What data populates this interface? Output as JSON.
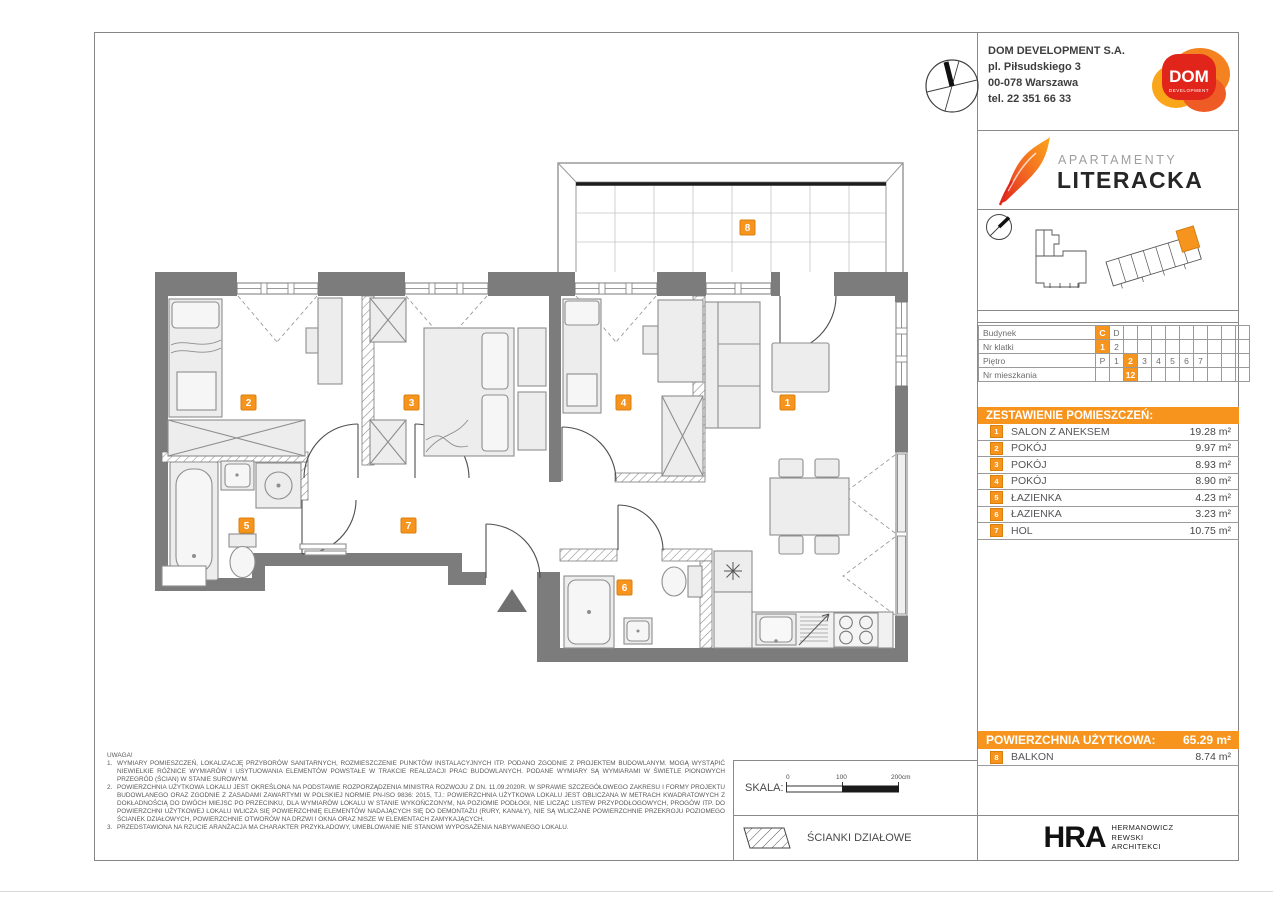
{
  "header": {
    "company_name": "DOM DEVELOPMENT S.A.",
    "address_line1": "pl. Piłsudskiego 3",
    "address_line2": "00-078 Warszawa",
    "phone": "tel. 22 351 66 33",
    "logo_text": "DOM",
    "logo_subtext": "DEVELOPMENT"
  },
  "brand": {
    "line1": "APARTAMENTY",
    "line2": "LITERACKA"
  },
  "unit_table": {
    "rows": [
      {
        "label": "Budynek",
        "cells": [
          "C",
          "D",
          "",
          "",
          "",
          "",
          "",
          "",
          "",
          "",
          ""
        ]
      },
      {
        "label": "Nr klatki",
        "cells": [
          "1",
          "2",
          "",
          "",
          "",
          "",
          "",
          "",
          "",
          "",
          ""
        ]
      },
      {
        "label": "Piętro",
        "cells": [
          "P",
          "1",
          "2",
          "3",
          "4",
          "5",
          "6",
          "7",
          "",
          "",
          ""
        ]
      },
      {
        "label": "Nr mieszkania",
        "cells": [
          "",
          "",
          "12",
          "",
          "",
          "",
          "",
          "",
          "",
          "",
          ""
        ]
      }
    ]
  },
  "rooms": {
    "header": "ZESTAWIENIE POMIESZCZEŃ:",
    "items": [
      {
        "no": "1",
        "name": "SALON Z ANEKSEM",
        "area": "19.28 m²"
      },
      {
        "no": "2",
        "name": "POKÓJ",
        "area": "9.97 m²"
      },
      {
        "no": "3",
        "name": "POKÓJ",
        "area": "8.93 m²"
      },
      {
        "no": "4",
        "name": "POKÓJ",
        "area": "8.90 m²"
      },
      {
        "no": "5",
        "name": "ŁAZIENKA",
        "area": "4.23 m²"
      },
      {
        "no": "6",
        "name": "ŁAZIENKA",
        "area": "3.23 m²"
      },
      {
        "no": "7",
        "name": "HOL",
        "area": "10.75 m²"
      }
    ]
  },
  "summary": {
    "label": "POWIERZCHNIA UŻYTKOWA:",
    "value": "65.29 m²",
    "balcony_no": "8",
    "balcony_name": "BALKON",
    "balcony_area": "8.74 m²"
  },
  "notes": {
    "title": "UWAGA!",
    "items": [
      "WYMIARY POMIESZCZEŃ, LOKALIZACJĘ PRZYBORÓW SANITARNYCH, ROZMIESZCZENIE PUNKTÓW INSTALACYJNYCH ITP. PODANO ZGODNIE Z PROJEKTEM BUDOWLANYM. MOGĄ WYSTĄPIĆ NIEWIELKIE RÓŻNICE WYMIARÓW I USYTUOWANIA ELEMENTÓW POWSTAŁE W TRAKCIE REALIZACJI PRAC BUDOWLANYCH. PODANE WYMIARY SĄ WYMIARAMI W ŚWIETLE PIONOWYCH PRZEGRÓD (ŚCIAN) W STANIE SUROWYM.",
      "POWIERZCHNIA UŻYTKOWA LOKALU JEST OKREŚLONA NA PODSTAWIE ROZPORZĄDZENIA MINISTRA ROZWOJU Z DN. 11.09.2020R. W SPRAWIE SZCZEGÓŁOWEGO ZAKRESU I FORMY PROJEKTU BUDOWLANEGO ORAZ ZGODNIE Z ZASADAMI ZAWARTYMI W POLSKIEJ NORMIE PN-ISO 9836: 2015, TJ.: POWIERZCHNIA UŻYTKOWA LOKALU JEST OBLICZANA W METRACH KWADRATOWYCH Z DOKŁADNOŚCIĄ DO DWÓCH MIEJSC PO PRZECINKU, DLA WYMIARÓW LOKALU W STANIE WYKOŃCZONYM, NA POZIOMIE PODŁOGI, NIE LICZĄC LISTEW PRZYPODŁOGOWYCH, PROGÓW ITP. DO POWIERZCHNI UŻYTKOWEJ LOKALU WLICZA SIĘ POWIERZCHNIĘ ELEMENTÓW NADAJĄCYCH SIĘ DO DEMONTAŻU (RURY, KANAŁY), NIE SĄ WLICZANE POWIERZCHNIE PRZEKROJU POZIOMEGO ŚCIANEK DZIAŁOWYCH, POWIERZCHNIE OTWORÓW NA DRZWI I OKNA ORAZ NISZE W ELEMENTACH ZAMYKAJĄCYCH.",
      "PRZEDSTAWIONA NA RZUCIE ARANŻACJA MA CHARAKTER PRZYKŁADOWY, UMEBLOWANIE NIE STANOWI WYPOSAŻENIA NABYWANEGO LOKALU."
    ]
  },
  "scale": {
    "label": "SKALA:",
    "t0": "0",
    "t100": "100",
    "t200": "200cm"
  },
  "legend": {
    "partition_walls": "ŚCIANKI DZIAŁOWE"
  },
  "architect": {
    "logo": "HRA",
    "line1": "HERMANOWICZ",
    "line2": "REWSKI",
    "line3": "ARCHITEKCI"
  },
  "plan": {
    "labels": [
      "1",
      "2",
      "3",
      "4",
      "5",
      "6",
      "7",
      "8"
    ]
  },
  "colors": {
    "accent": "#F7941E",
    "wall": "#7C7C7C",
    "logo_red": "#E1251B"
  }
}
